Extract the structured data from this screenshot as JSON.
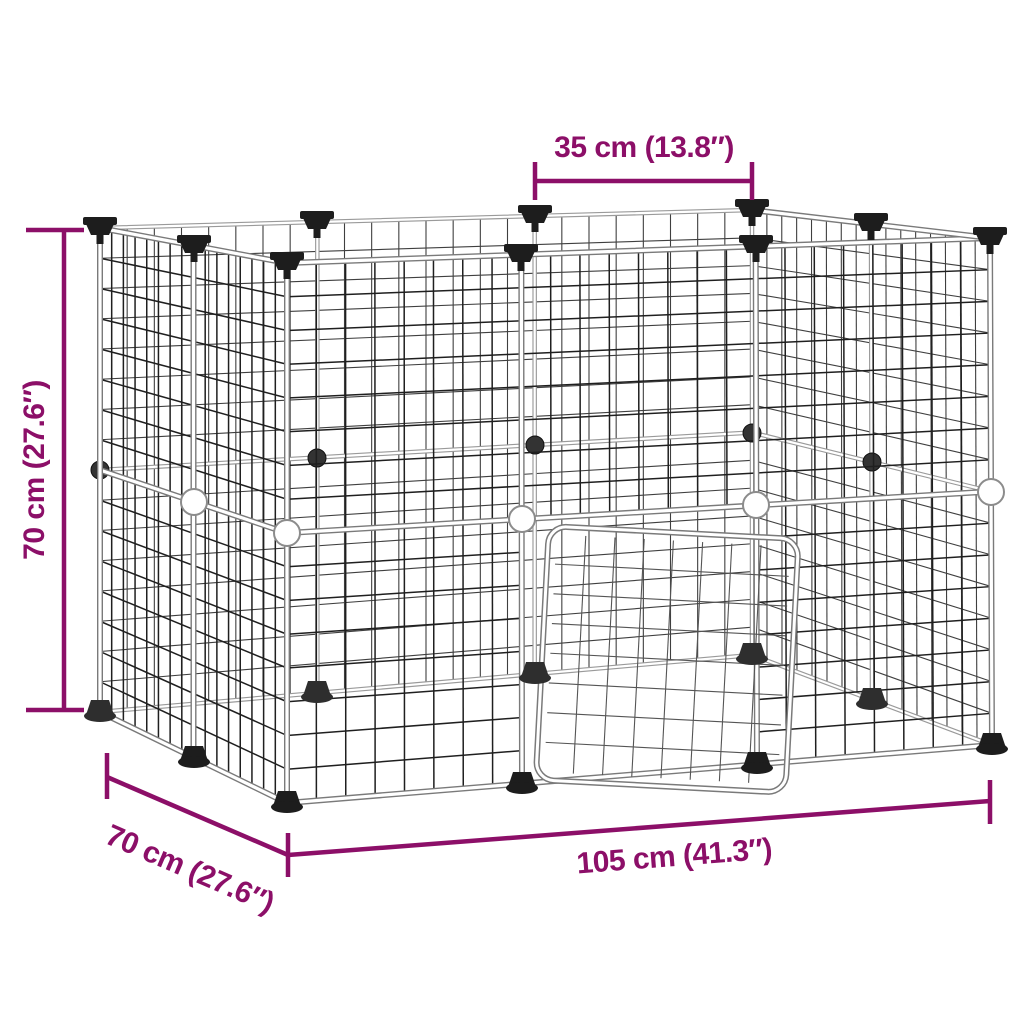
{
  "diagram": {
    "dimensions": {
      "top_width": {
        "label": "35 cm (13.8″)"
      },
      "height": {
        "label": "70 cm (27.6″)"
      },
      "depth": {
        "label": "70 cm (27.6″)"
      },
      "length": {
        "label": "105 cm (41.3″)"
      }
    },
    "colors": {
      "dimension_accent": "#8C0F68",
      "wire_near": "#1f1f1f",
      "wire_far": "#3f3f3f",
      "frame_tube_outline": "#7a7a7a",
      "frame_tube_far": "#9a9a9a",
      "frame_tube_core": "#ffffff",
      "hardware_black": "#1d1d1d",
      "hardware_far": "#2e2e2e",
      "connector_white": "#ffffff",
      "connector_stroke": "#8c8c8c",
      "background": "#ffffff"
    }
  }
}
